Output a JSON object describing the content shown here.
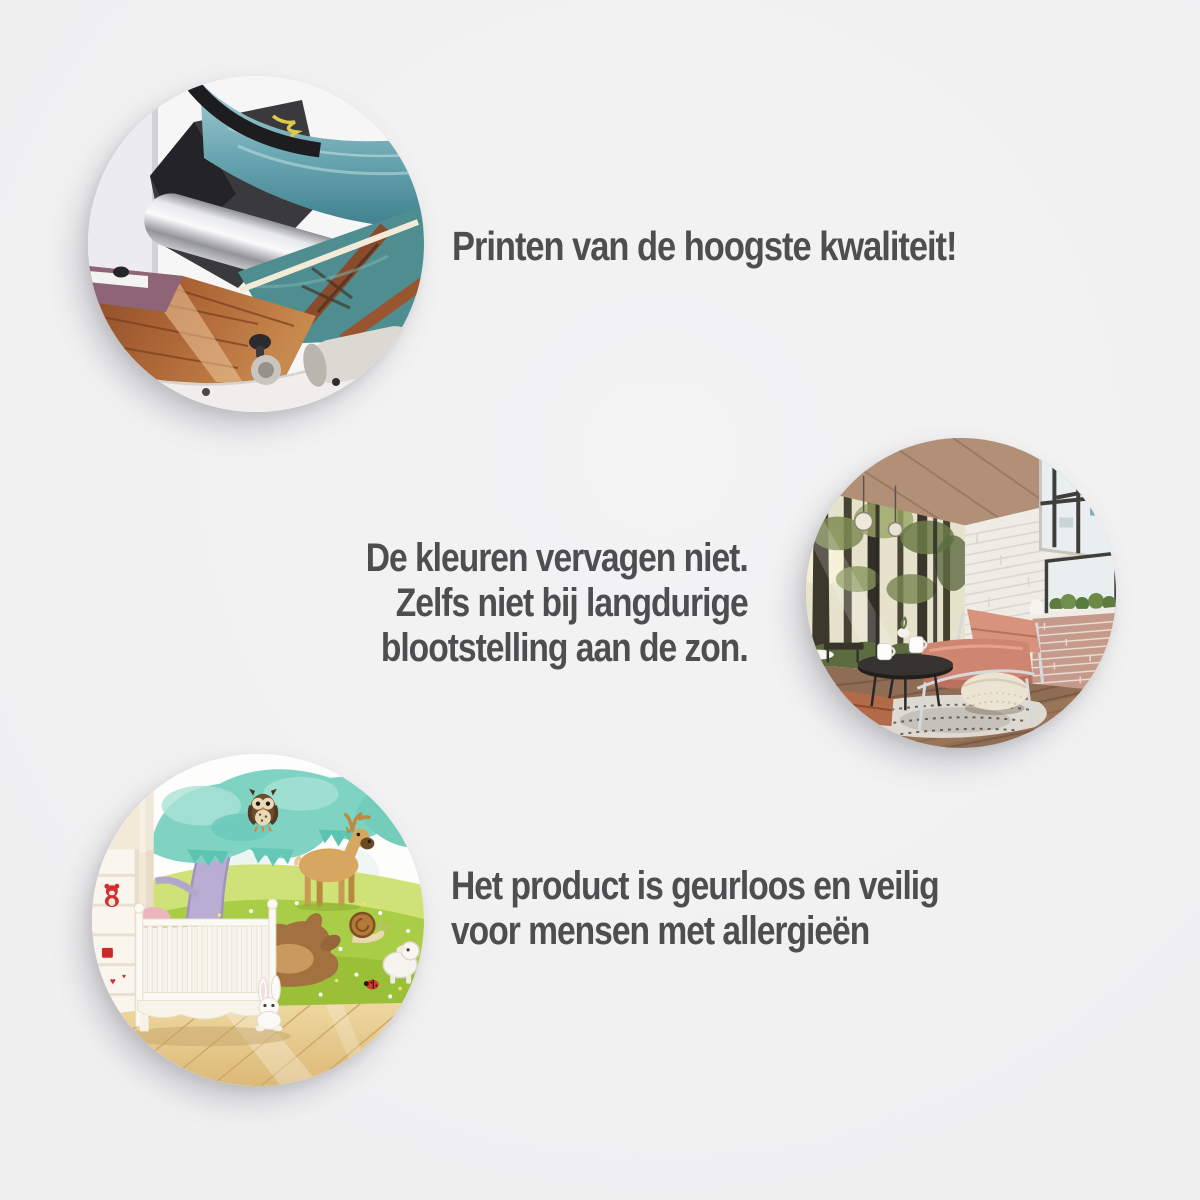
{
  "page": {
    "background_color": "#f0f0f1",
    "text_color": "#4e4e50",
    "language": "nl"
  },
  "features": [
    {
      "id": "print-quality",
      "photo_name": "printing-machine-photo",
      "photo_alt": "Grootformaat printer met fotoprint op de rol",
      "lines": [
        "Printen van de hoogste kwaliteit!"
      ]
    },
    {
      "id": "colors-no-fade",
      "photo_name": "forest-wallpaper-interior-photo",
      "photo_alt": "Interieur met fotobehang van een bos, fauteuil en salontafel",
      "lines": [
        "De kleuren vervagen niet.",
        "Zelfs niet bij langdurige",
        "blootstelling aan de zon."
      ]
    },
    {
      "id": "odorless-allergy-safe",
      "photo_name": "nursery-wallpaper-photo",
      "photo_alt": "Kinderkamer met dierenbehang en wit ledikant",
      "lines": [
        "Het product is geurloos en veilig",
        "voor mensen met allergieën"
      ]
    }
  ]
}
